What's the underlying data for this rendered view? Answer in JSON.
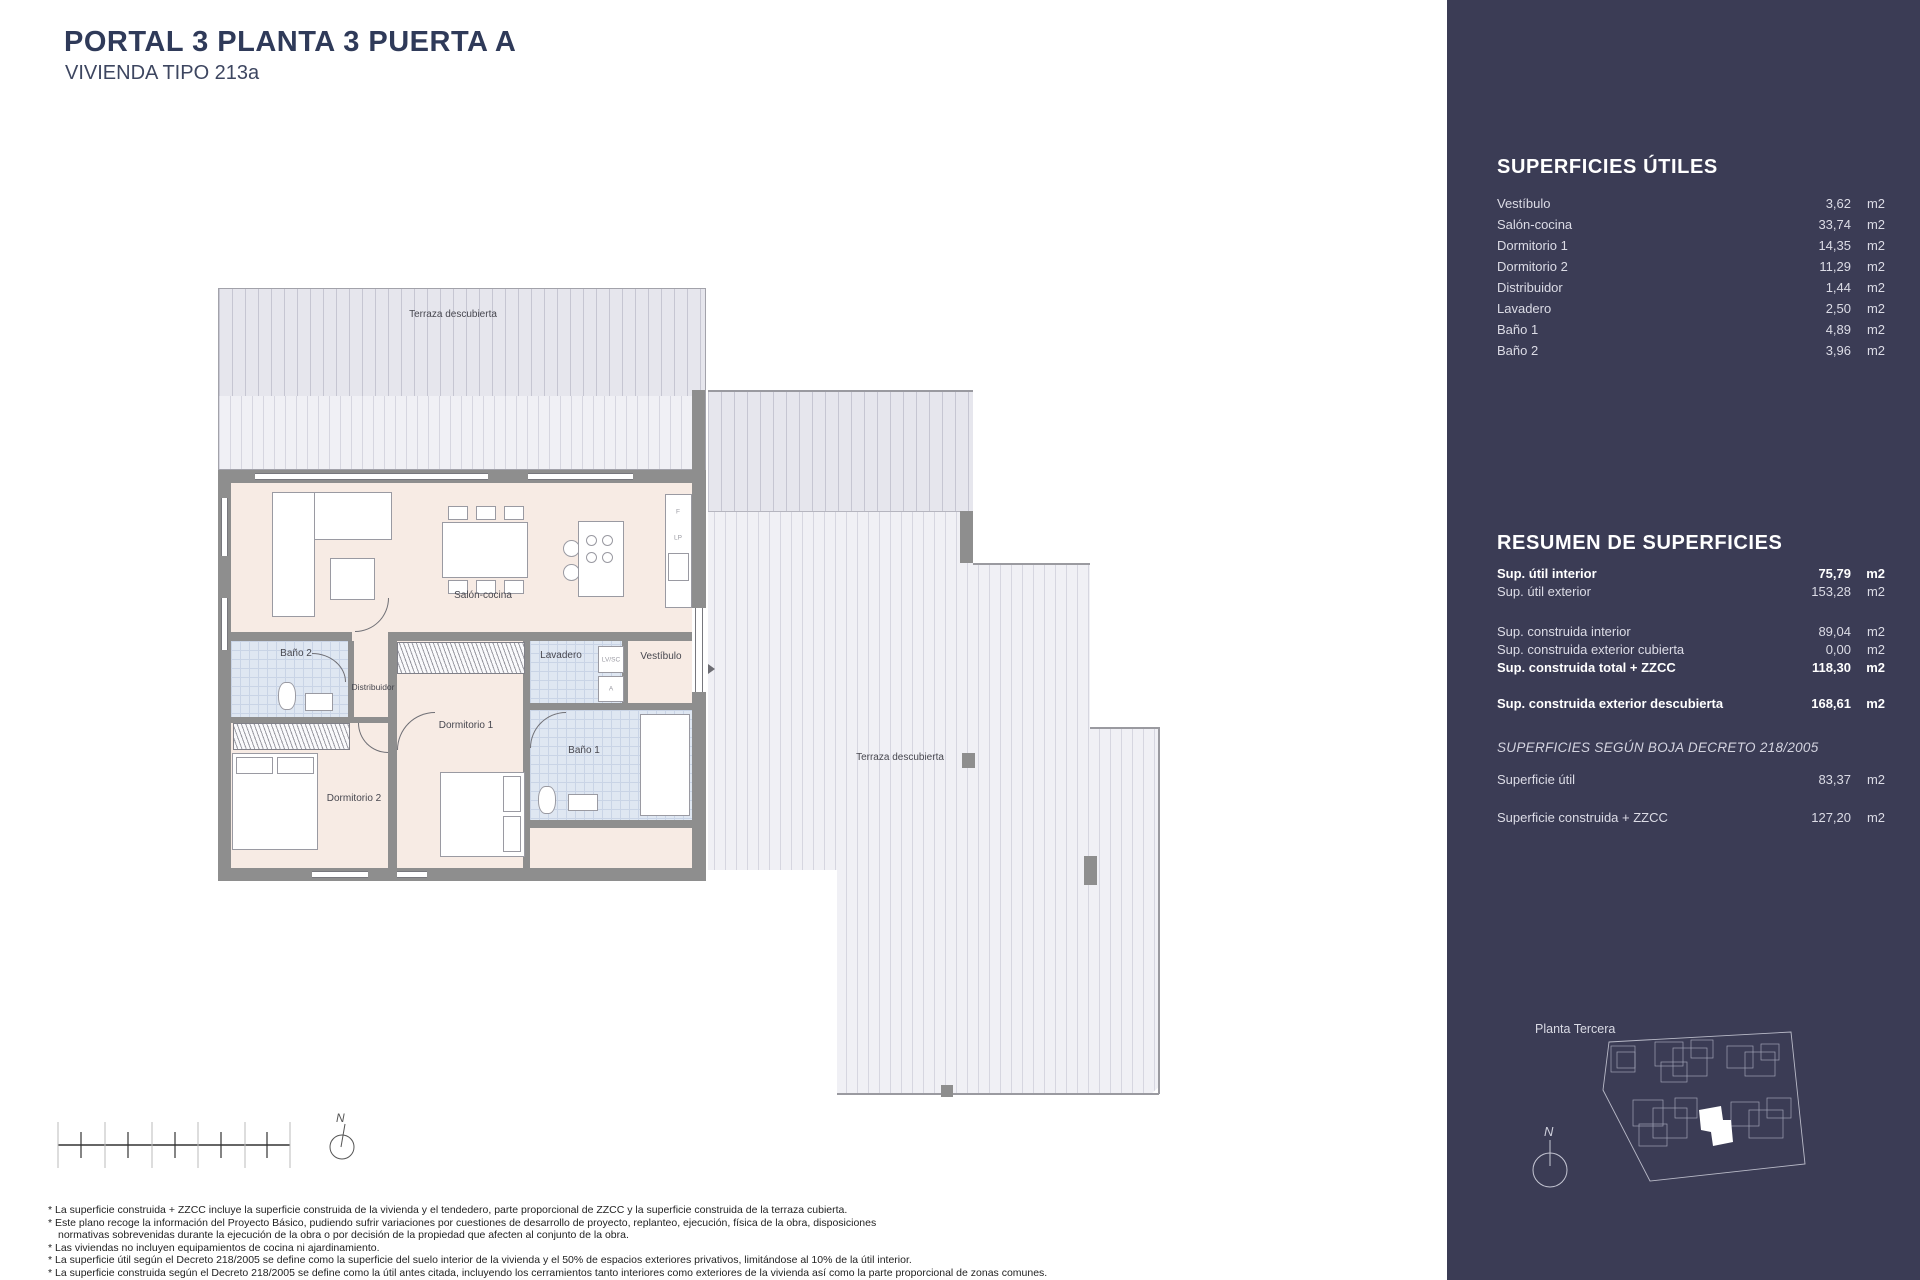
{
  "colors": {
    "sidebar_bg": "#3b3c55",
    "title_navy": "#2f3a59",
    "floor_pink": "#f7ebe4",
    "tile_blue": "#dfe7f2",
    "wall_gray": "#8e8e8e",
    "terrace_hatch": "#e6e6ed"
  },
  "header": {
    "title": "PORTAL 3  PLANTA 3 PUERTA A",
    "subtitle": "VIVIENDA TIPO 213a"
  },
  "sidebar": {
    "superficies_utiles": {
      "heading": "SUPERFICIES ÚTILES",
      "rows": [
        {
          "label": "Vestíbulo",
          "value": "3,62",
          "unit": "m2"
        },
        {
          "label": "Salón-cocina",
          "value": "33,74",
          "unit": "m2"
        },
        {
          "label": "Dormitorio 1",
          "value": "14,35",
          "unit": "m2"
        },
        {
          "label": "Dormitorio 2",
          "value": "11,29",
          "unit": "m2"
        },
        {
          "label": "Distribuidor",
          "value": "1,44",
          "unit": "m2"
        },
        {
          "label": "Lavadero",
          "value": "2,50",
          "unit": "m2"
        },
        {
          "label": "Baño 1",
          "value": "4,89",
          "unit": "m2"
        },
        {
          "label": "Baño 2",
          "value": "3,96",
          "unit": "m2"
        }
      ]
    },
    "resumen": {
      "heading": "RESUMEN  DE SUPERFICIES",
      "rows": [
        {
          "label": "Sup. útil interior",
          "value": "75,79",
          "unit": "m2"
        },
        {
          "label": "Sup. útil exterior",
          "value": "153,28",
          "unit": "m2"
        },
        {
          "label": "Sup. construida interior",
          "value": "89,04",
          "unit": "m2"
        },
        {
          "label": "Sup. construida exterior cubierta",
          "value": "0,00",
          "unit": "m2"
        },
        {
          "label": "Sup. construida total + ZZCC",
          "value": "118,30",
          "unit": "m2"
        },
        {
          "label": "Sup. construida exterior descubierta",
          "value": "168,61",
          "unit": "m2"
        }
      ]
    },
    "boja": {
      "heading": "SUPERFICIES SEGÚN BOJA DECRETO 218/2005",
      "rows": [
        {
          "label": "Superficie útil",
          "value": "83,37",
          "unit": "m2"
        },
        {
          "label": "Superficie construida + ZZCC",
          "value": "127,20",
          "unit": "m2"
        }
      ]
    },
    "siteplan": {
      "label": "Planta Tercera",
      "north_label": "N"
    }
  },
  "plan": {
    "labels": {
      "terrace_top": "Terraza descubierta",
      "terrace_right": "Terraza descubierta",
      "salon": "Salón-cocina",
      "bano2": "Baño 2",
      "distribuidor": "Distribuidor",
      "dormitorio2": "Dormitorio 2",
      "dormitorio1": "Dormitorio 1",
      "lavadero": "Lavadero",
      "vestibulo": "Vestíbulo",
      "bano1": "Baño 1",
      "lv_sc": "LV/SC",
      "a": "A",
      "f": "F",
      "lp": "LP"
    },
    "north_label": "N"
  },
  "footnotes": {
    "lines": [
      "* La superficie construida + ZZCC incluye la superficie construida de la vivienda y el tendedero, parte proporcional de ZZCC y la superficie construida de la terraza cubierta.",
      "* Este plano recoge la información del Proyecto Básico, pudiendo sufrir variaciones por cuestiones de desarrollo de proyecto, replanteo, ejecución, física de la obra, disposiciones",
      "normativas sobrevenidas durante la ejecución de la obra o por decisión de la propiedad que afecten al conjunto de la obra.",
      "* Las viviendas no incluyen equipamientos de cocina ni ajardinamiento.",
      "* La superficie útil según el Decreto 218/2005 se define como la superficie del suelo interior de la vivienda y el 50% de espacios exteriores privativos, limitándose al 10% de la útil interior.",
      "* La superficie construida según el Decreto 218/2005 se define como la útil antes citada, incluyendo los cerramientos tanto interiores como exteriores de la vivienda así como la parte proporcional de zonas comunes."
    ]
  }
}
